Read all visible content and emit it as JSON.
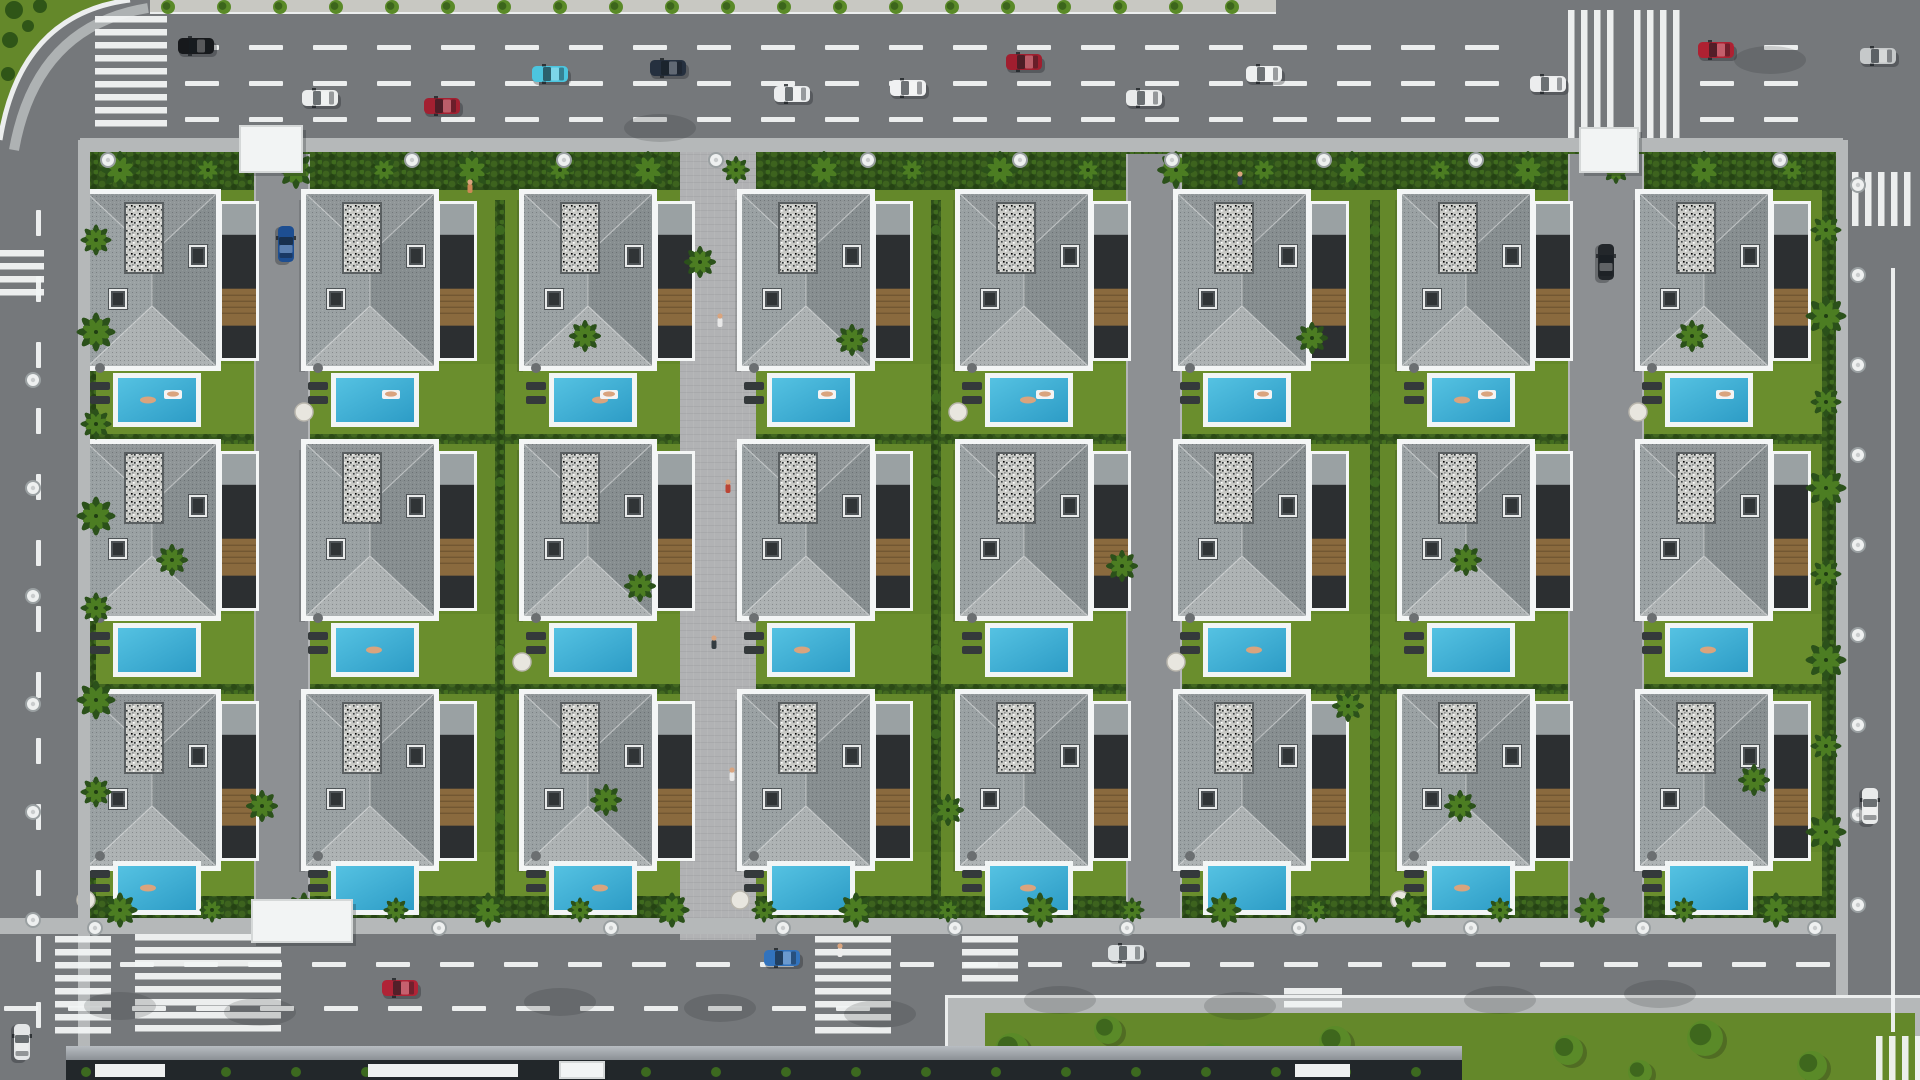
{
  "canvas": {
    "w": 1920,
    "h": 1080
  },
  "palette": {
    "asphalt": "#75787b",
    "asphaltLight": "#85888b",
    "drive": "#8d9093",
    "paver": "#b1b2b4",
    "sidewalk": "#b5b8b9",
    "curb": "#eceeee",
    "lane": "#f2f4f4",
    "lawn": "#64882a",
    "lawnLight": "#6f9430",
    "hedge": "#2e4f1a",
    "hedgeLight": "#41691f",
    "palmDark": "#2b511a",
    "palmLight": "#4c7d22",
    "treeDark": "#2f5517",
    "treeLight": "#5a8a28",
    "roofTop": "#909698",
    "roofBottom": "#adb2b3",
    "roofLeft": "#9aa1a3",
    "roofRight": "#878e90",
    "parapet": "#f4f6f6",
    "gravel": "#c9cac6",
    "chimney": "#4e5356",
    "chimneyRim": "#e8eaea",
    "wing": "#2c2f31",
    "wood": "#8a6a3e",
    "poolDeep": "#2d9cc6",
    "poolShallow": "#55c2e2",
    "poolRim": "#f2f5f5",
    "wall": "#3f4346",
    "glassTop": "#b8bdc2",
    "glassBottom": "#8b9095",
    "canopyDark": "#22272a",
    "medianPave": "#c8c8c2",
    "skin": "#d9a47e",
    "lounger": "#34393b",
    "shadow": "rgba(25,29,31,0.16)"
  },
  "roads": {
    "top": {
      "x": 0,
      "y": 0,
      "w": 1920,
      "h": 140
    },
    "bottom": {
      "x": 0,
      "y": 932,
      "w": 1920,
      "h": 108
    },
    "left": {
      "x": 0,
      "y": 0,
      "w": 80,
      "h": 1080
    },
    "right": {
      "x": 1845,
      "y": 0,
      "w": 75,
      "h": 1080
    }
  },
  "median": {
    "x": 150,
    "y": 0,
    "w": 1126,
    "h": 14,
    "treeStep": 56,
    "treeR": 7
  },
  "dashRows": [
    {
      "y": 45,
      "segs": [
        [
          185,
          1550
        ],
        [
          1700,
          1842
        ]
      ]
    },
    {
      "y": 81,
      "segs": [
        [
          185,
          1550
        ],
        [
          1700,
          1842
        ]
      ]
    },
    {
      "y": 117,
      "segs": [
        [
          185,
          1550
        ],
        [
          1700,
          1842
        ]
      ]
    },
    {
      "y": 962,
      "segs": [
        [
          120,
          800
        ],
        [
          900,
          1855
        ]
      ]
    },
    {
      "y": 1006,
      "segs": [
        [
          4,
          926
        ]
      ]
    }
  ],
  "dashSpec": {
    "len": 34,
    "gap": 30,
    "h": 5
  },
  "vDash": {
    "x": 36,
    "y1": 210,
    "y2": 1076,
    "len": 26,
    "gap": 40,
    "w": 5
  },
  "solidLines": [
    {
      "x1": 1893,
      "y1": 268,
      "x2": 1893,
      "y2": 1032
    }
  ],
  "crosswalks": [
    {
      "x": 95,
      "y": 16,
      "w": 72,
      "h": 120,
      "dir": "h"
    },
    {
      "x": 1568,
      "y": 10,
      "w": 54,
      "h": 128,
      "dir": "v"
    },
    {
      "x": 1634,
      "y": 10,
      "w": 54,
      "h": 128,
      "dir": "v"
    },
    {
      "x": 1852,
      "y": 172,
      "w": 66,
      "h": 54,
      "dir": "v"
    },
    {
      "x": 0,
      "y": 250,
      "w": 44,
      "h": 48,
      "dir": "h"
    },
    {
      "x": 55,
      "y": 936,
      "w": 56,
      "h": 100,
      "dir": "h"
    },
    {
      "x": 135,
      "y": 934,
      "w": 146,
      "h": 104,
      "dir": "h"
    },
    {
      "x": 815,
      "y": 936,
      "w": 76,
      "h": 102,
      "dir": "h"
    },
    {
      "x": 962,
      "y": 936,
      "w": 56,
      "h": 50,
      "dir": "h"
    },
    {
      "x": 1284,
      "y": 988,
      "w": 58,
      "h": 26,
      "dir": "h"
    },
    {
      "x": 1876,
      "y": 1036,
      "w": 44,
      "h": 44,
      "dir": "v"
    }
  ],
  "complex": {
    "x": 80,
    "y": 148,
    "w": 1762,
    "h": 774
  },
  "columns": [
    88,
    306,
    524,
    742,
    960,
    1178,
    1402,
    1640
  ],
  "rows": [
    194,
    444,
    694
  ],
  "connectors": [
    "drive",
    "green",
    "promenade",
    "green",
    "drive",
    "green",
    "drive"
  ],
  "villa": {
    "w": 170,
    "mainW": 128,
    "h": 172,
    "wingDx": 134,
    "wingW": 34,
    "wingDy": 10,
    "wingH": 154,
    "gravel": {
      "dx": 38,
      "dy": 10,
      "w": 36,
      "h": 68
    },
    "chimA": {
      "dx": 22,
      "dy": 96,
      "w": 16,
      "h": 18
    },
    "chimB": {
      "dx": 102,
      "dy": 52,
      "w": 16,
      "h": 20
    },
    "ridgeTop": 60,
    "ridgeBottom": 112
  },
  "pools": {
    "dx": 30,
    "w": 78,
    "h": 44,
    "rowY": [
      378,
      628,
      866
    ]
  },
  "hedgeBands": [
    {
      "y": 150,
      "h": 40
    },
    {
      "y": 896,
      "h": 24
    }
  ],
  "innerHedges": [
    {
      "y": 434,
      "h": 10
    },
    {
      "y": 684,
      "h": 10
    }
  ],
  "gates": [
    {
      "x": 240,
      "y": 126,
      "w": 62,
      "h": 46
    },
    {
      "x": 1580,
      "y": 128,
      "w": 58,
      "h": 44
    },
    {
      "x": 252,
      "y": 900,
      "w": 100,
      "h": 42
    },
    {
      "x": 560,
      "y": 1062,
      "w": 44,
      "h": 16
    }
  ],
  "canopyStrip": {
    "x": 66,
    "y": 1046,
    "w": 1396,
    "h": 34,
    "boxes": [
      [
        95,
        70
      ],
      [
        368,
        150
      ],
      [
        1295,
        55
      ]
    ]
  },
  "park": {
    "x": 945,
    "y": 995,
    "w": 975,
    "h": 85,
    "lawnPad": [
      40,
      18
    ],
    "trees": [
      [
        1012,
        1050,
        17
      ],
      [
        1108,
        1030,
        14
      ],
      [
        1215,
        1062,
        19
      ],
      [
        1335,
        1042,
        16
      ],
      [
        1438,
        1068,
        20
      ],
      [
        1568,
        1050,
        15
      ],
      [
        1705,
        1038,
        18
      ],
      [
        1812,
        1066,
        15
      ],
      [
        1102,
        1074,
        11
      ],
      [
        1640,
        1072,
        12
      ]
    ]
  },
  "lamps": {
    "top": {
      "y": 160,
      "x1": 108,
      "x2": 1810,
      "step": 152
    },
    "bottom": {
      "y": 928,
      "x1": 95,
      "x2": 1820,
      "step": 172
    },
    "right": {
      "x": 1858,
      "y1": 185,
      "y2": 905,
      "step": 90
    },
    "left": {
      "x": 33,
      "y1": 380,
      "y2": 920,
      "step": 108
    }
  },
  "palmRows": {
    "top": {
      "y": 170,
      "x1": 120,
      "x2": 1810,
      "step": 88
    },
    "bottom": {
      "y": 910,
      "x1": 120,
      "x2": 1800,
      "step": 92
    },
    "left": {
      "x": 96,
      "y1": 240,
      "y2": 880,
      "step": 92
    },
    "right": {
      "x": 1826,
      "y1": 230,
      "y2": 890,
      "step": 86
    }
  },
  "extraPalms": [
    [
      585,
      336
    ],
    [
      852,
      340
    ],
    [
      1312,
      338
    ],
    [
      172,
      560
    ],
    [
      640,
      586
    ],
    [
      1122,
      566
    ],
    [
      1466,
      560
    ],
    [
      262,
      806
    ],
    [
      606,
      800
    ],
    [
      948,
      810
    ],
    [
      1692,
      336
    ],
    [
      1754,
      780
    ],
    [
      700,
      262
    ],
    [
      1348,
      706
    ],
    [
      1460,
      806
    ]
  ],
  "cars": {
    "horizontal": [
      [
        196,
        46,
        "#17191c"
      ],
      [
        320,
        98,
        "#ebeded"
      ],
      [
        442,
        106,
        "#a32031"
      ],
      [
        550,
        74,
        "#4cc5df"
      ],
      [
        668,
        68,
        "#25303f"
      ],
      [
        792,
        94,
        "#ebedee"
      ],
      [
        908,
        88,
        "#f0f1f2"
      ],
      [
        1024,
        62,
        "#a01e2f"
      ],
      [
        1144,
        98,
        "#e9ebeb"
      ],
      [
        1264,
        74,
        "#eef0f0"
      ],
      [
        1548,
        84,
        "#ecedee"
      ],
      [
        1716,
        50,
        "#ae2132"
      ],
      [
        1878,
        56,
        "#c6c9ca"
      ],
      [
        400,
        988,
        "#b02336"
      ],
      [
        782,
        958,
        "#3273bd"
      ],
      [
        1126,
        953,
        "#dde1e2"
      ]
    ],
    "vertical": [
      [
        286,
        244,
        "#1d4e91"
      ],
      [
        1606,
        262,
        "#23272b"
      ],
      [
        1870,
        806,
        "#e9ebeb"
      ],
      [
        22,
        1042,
        "#e4e6e7"
      ]
    ]
  },
  "people": [
    [
      720,
      320,
      "#e8e8e8"
    ],
    [
      728,
      486,
      "#bb4433"
    ],
    [
      714,
      642,
      "#333b40"
    ],
    [
      732,
      774,
      "#e8e8e8"
    ],
    [
      470,
      186,
      "#cc8855"
    ],
    [
      840,
      950,
      "#eeeeee"
    ],
    [
      1240,
      178,
      "#334455"
    ]
  ],
  "roadShadows": [
    [
      560,
      1002
    ],
    [
      720,
      1008
    ],
    [
      880,
      1014
    ],
    [
      1060,
      1000
    ],
    [
      1240,
      1006
    ],
    [
      1500,
      1000
    ],
    [
      1660,
      994
    ],
    [
      120,
      1006
    ],
    [
      260,
      1012
    ],
    [
      1770,
      60
    ],
    [
      660,
      128
    ]
  ]
}
